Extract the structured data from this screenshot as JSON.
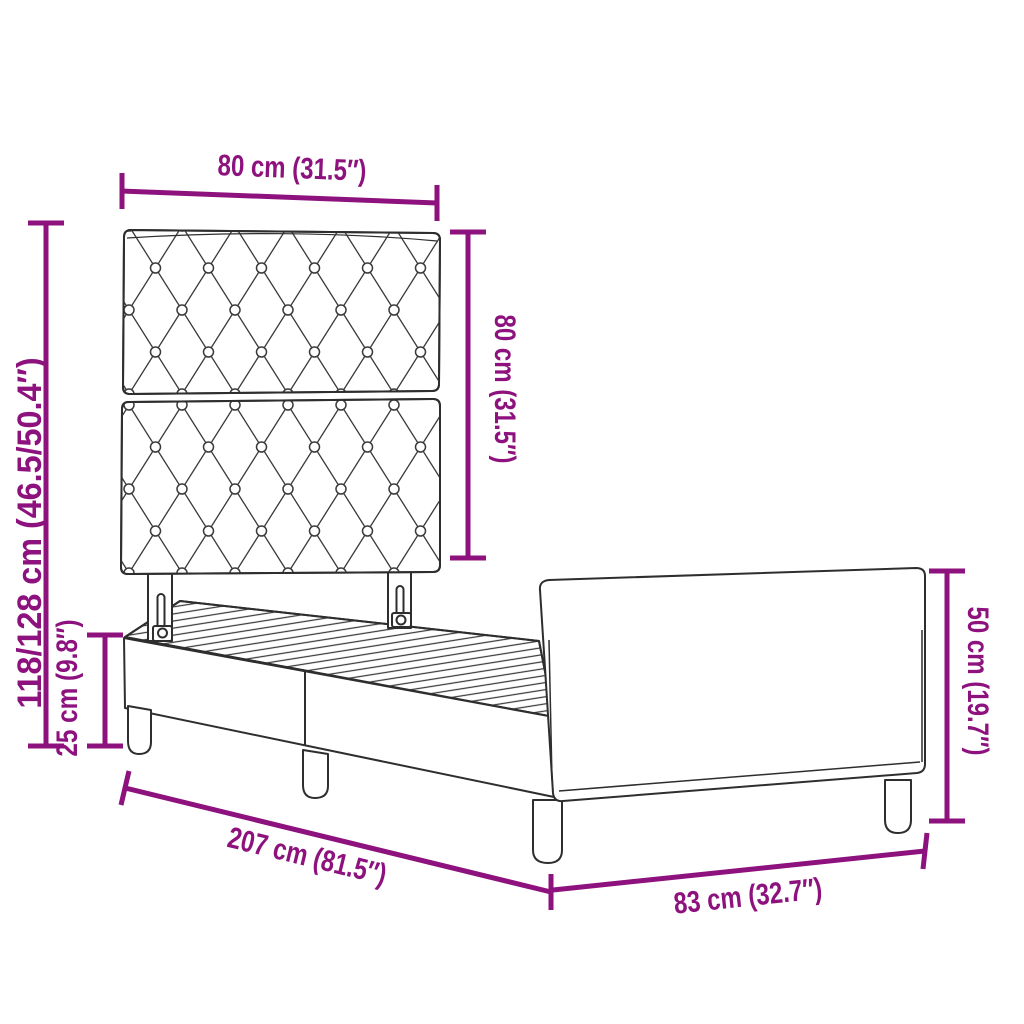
{
  "diagram": {
    "accent_color": "#8d127e",
    "line_color": "#2e2e2e",
    "dimensions": {
      "headboard_width": "80 cm (31.5″)",
      "headboard_height": "80 cm (31.5″)",
      "total_height": "118/128 cm (46.5/50.4″)",
      "base_height": "25 cm (9.8″)",
      "footboard_height": "50 cm (19.7″)",
      "frame_length": "207 cm (81.5″)",
      "frame_width": "83 cm (32.7″)"
    }
  }
}
